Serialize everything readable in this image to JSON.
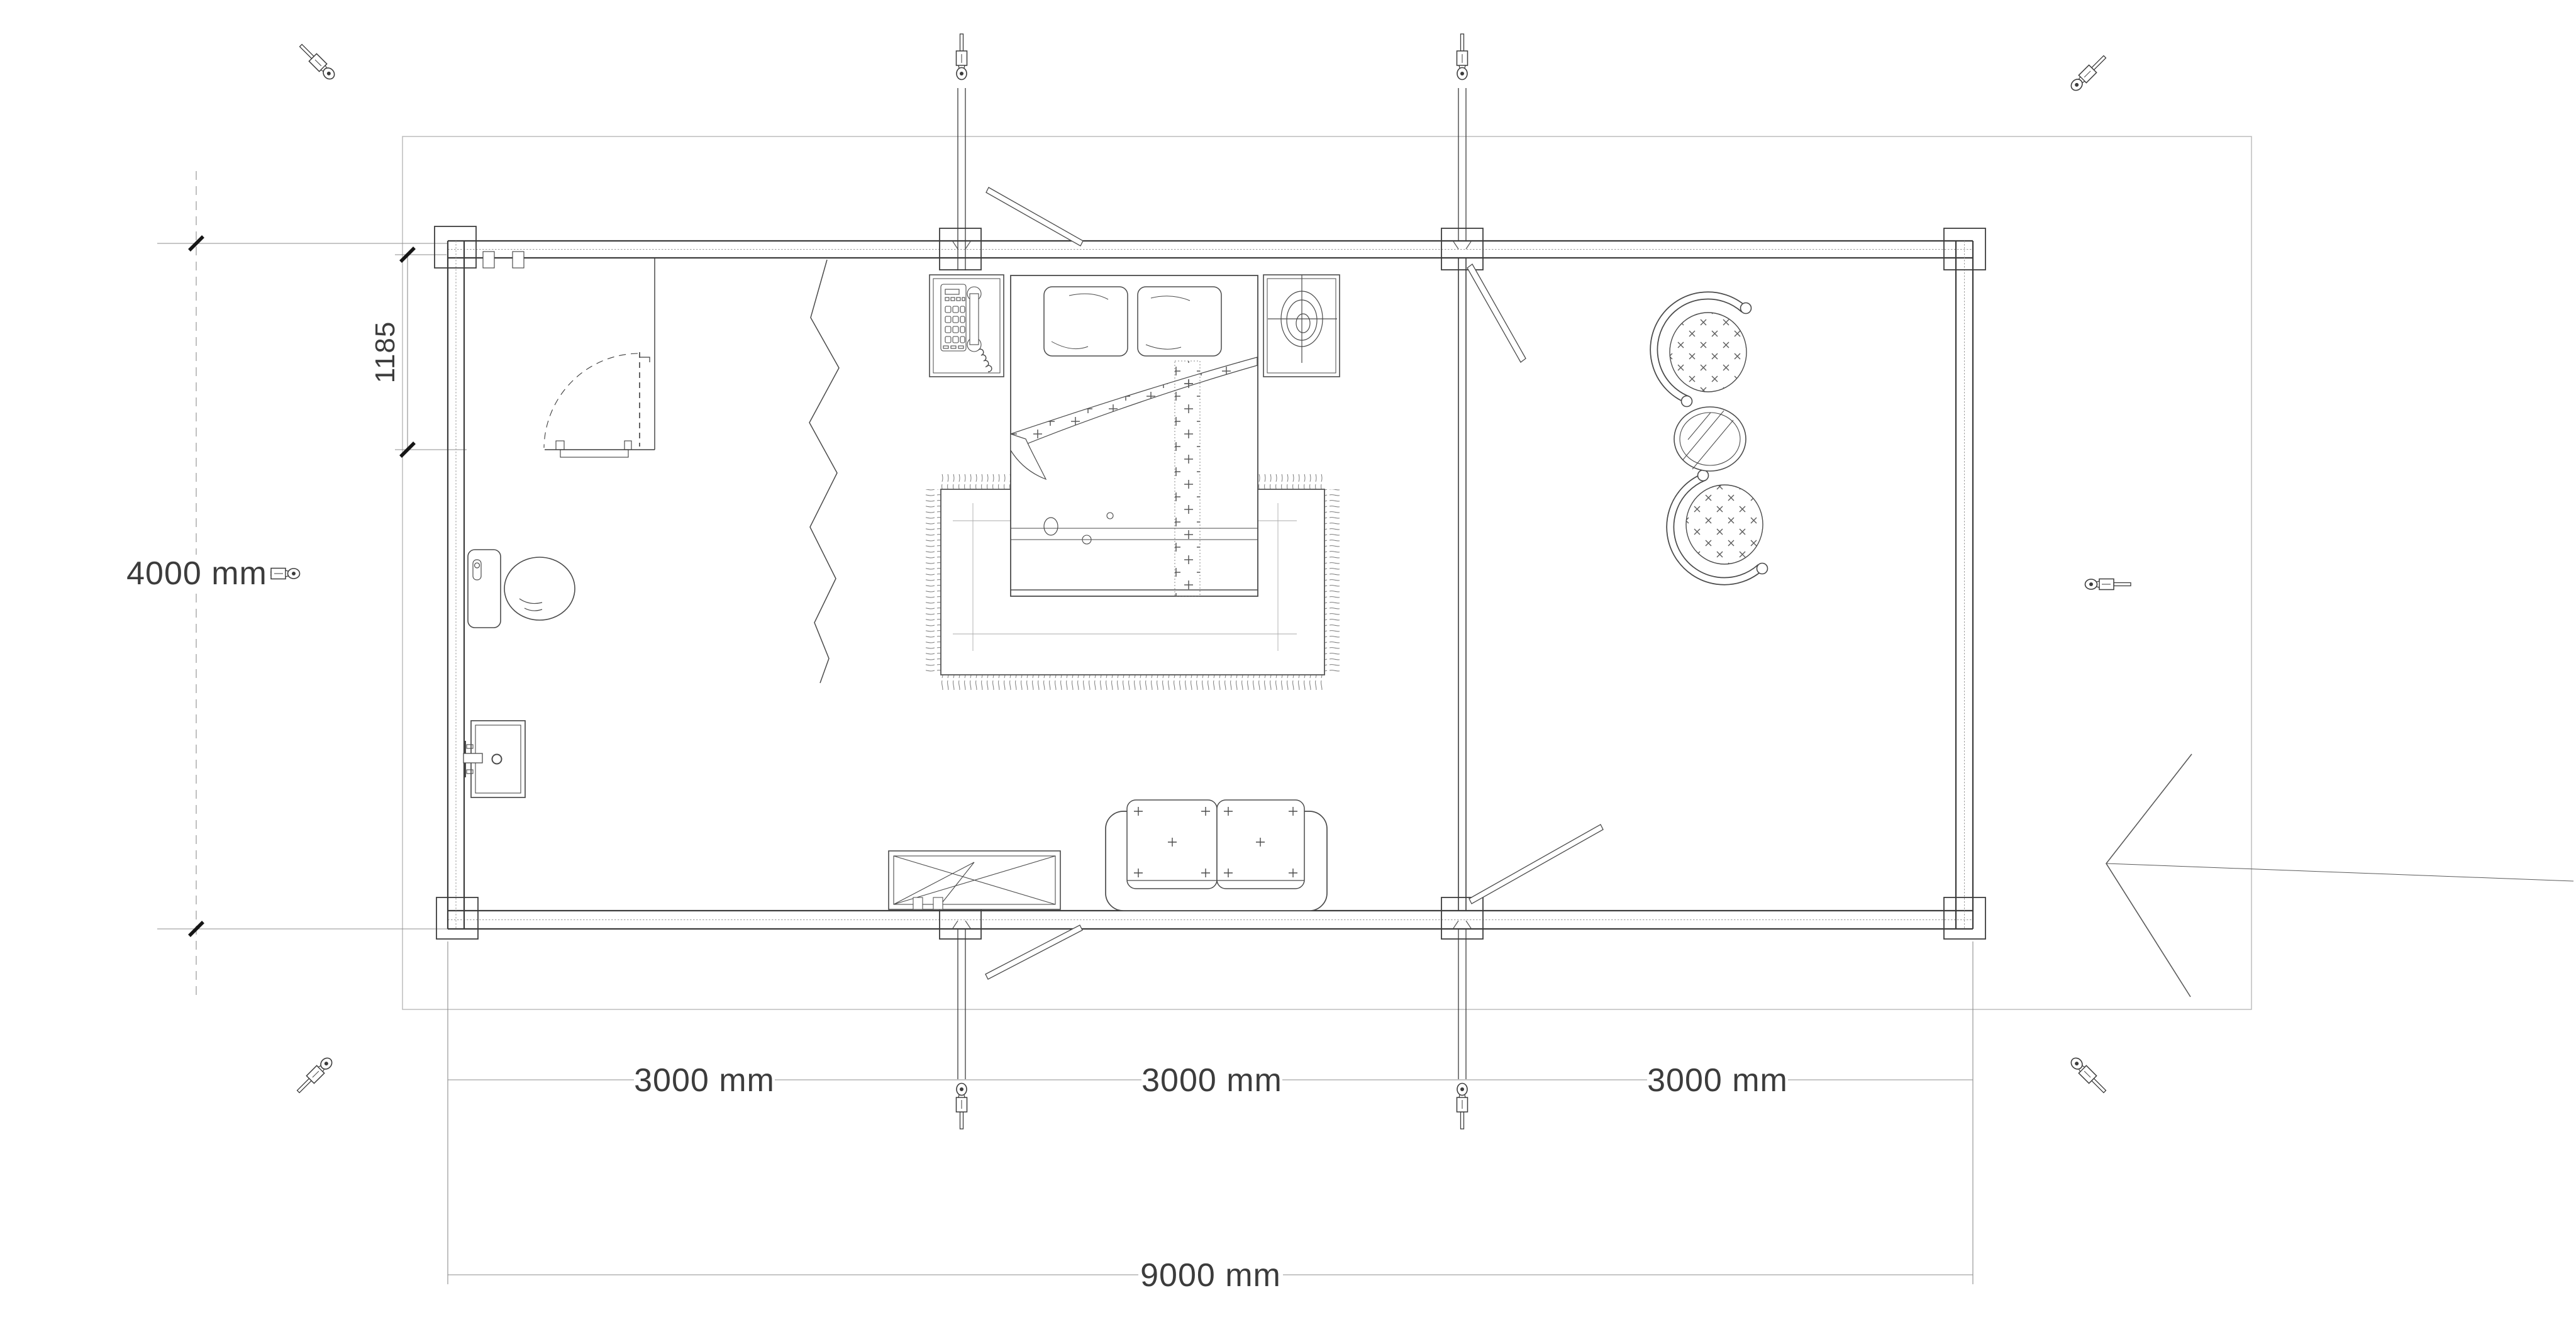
{
  "meta": {
    "drawing_type": "floor-plan",
    "units": "mm"
  },
  "palette": {
    "background": "#ffffff",
    "wall_line": "#3c3c3c",
    "furniture_line": "#4a4a4a",
    "light_line": "#a8a8a8",
    "dim_line": "#8c8c8c",
    "boundary_line": "#b8b8b8",
    "tick": "#161616",
    "dim_text": "#3c3c3c"
  },
  "dimensions": {
    "total_width_label": "9000 mm",
    "segment_labels": [
      "3000 mm",
      "3000 mm",
      "3000 mm"
    ],
    "total_height_label": "4000 mm",
    "offset_label": "1185"
  },
  "components": {
    "structure": [
      "site-boundary",
      "exterior-log-walls",
      "corner-posts",
      "wall-posts",
      "room-divider-wall",
      "anchor-poles",
      "entrance-arrow"
    ],
    "furniture": [
      "double-bed",
      "pillows",
      "blanket-fold",
      "bed-runner",
      "area-rug",
      "bedside-table-left",
      "telephone",
      "bedside-table-right",
      "table-lamp",
      "loveseat-sofa",
      "crossed-table",
      "armchair-top",
      "armchair-bottom",
      "round-side-table",
      "toilet",
      "washbasin",
      "bathroom-door",
      "zigzag-curtain",
      "window-sash-strips"
    ],
    "icons": [
      "turnbuckle-anchor-icon",
      "corner-anchor-icon"
    ]
  }
}
